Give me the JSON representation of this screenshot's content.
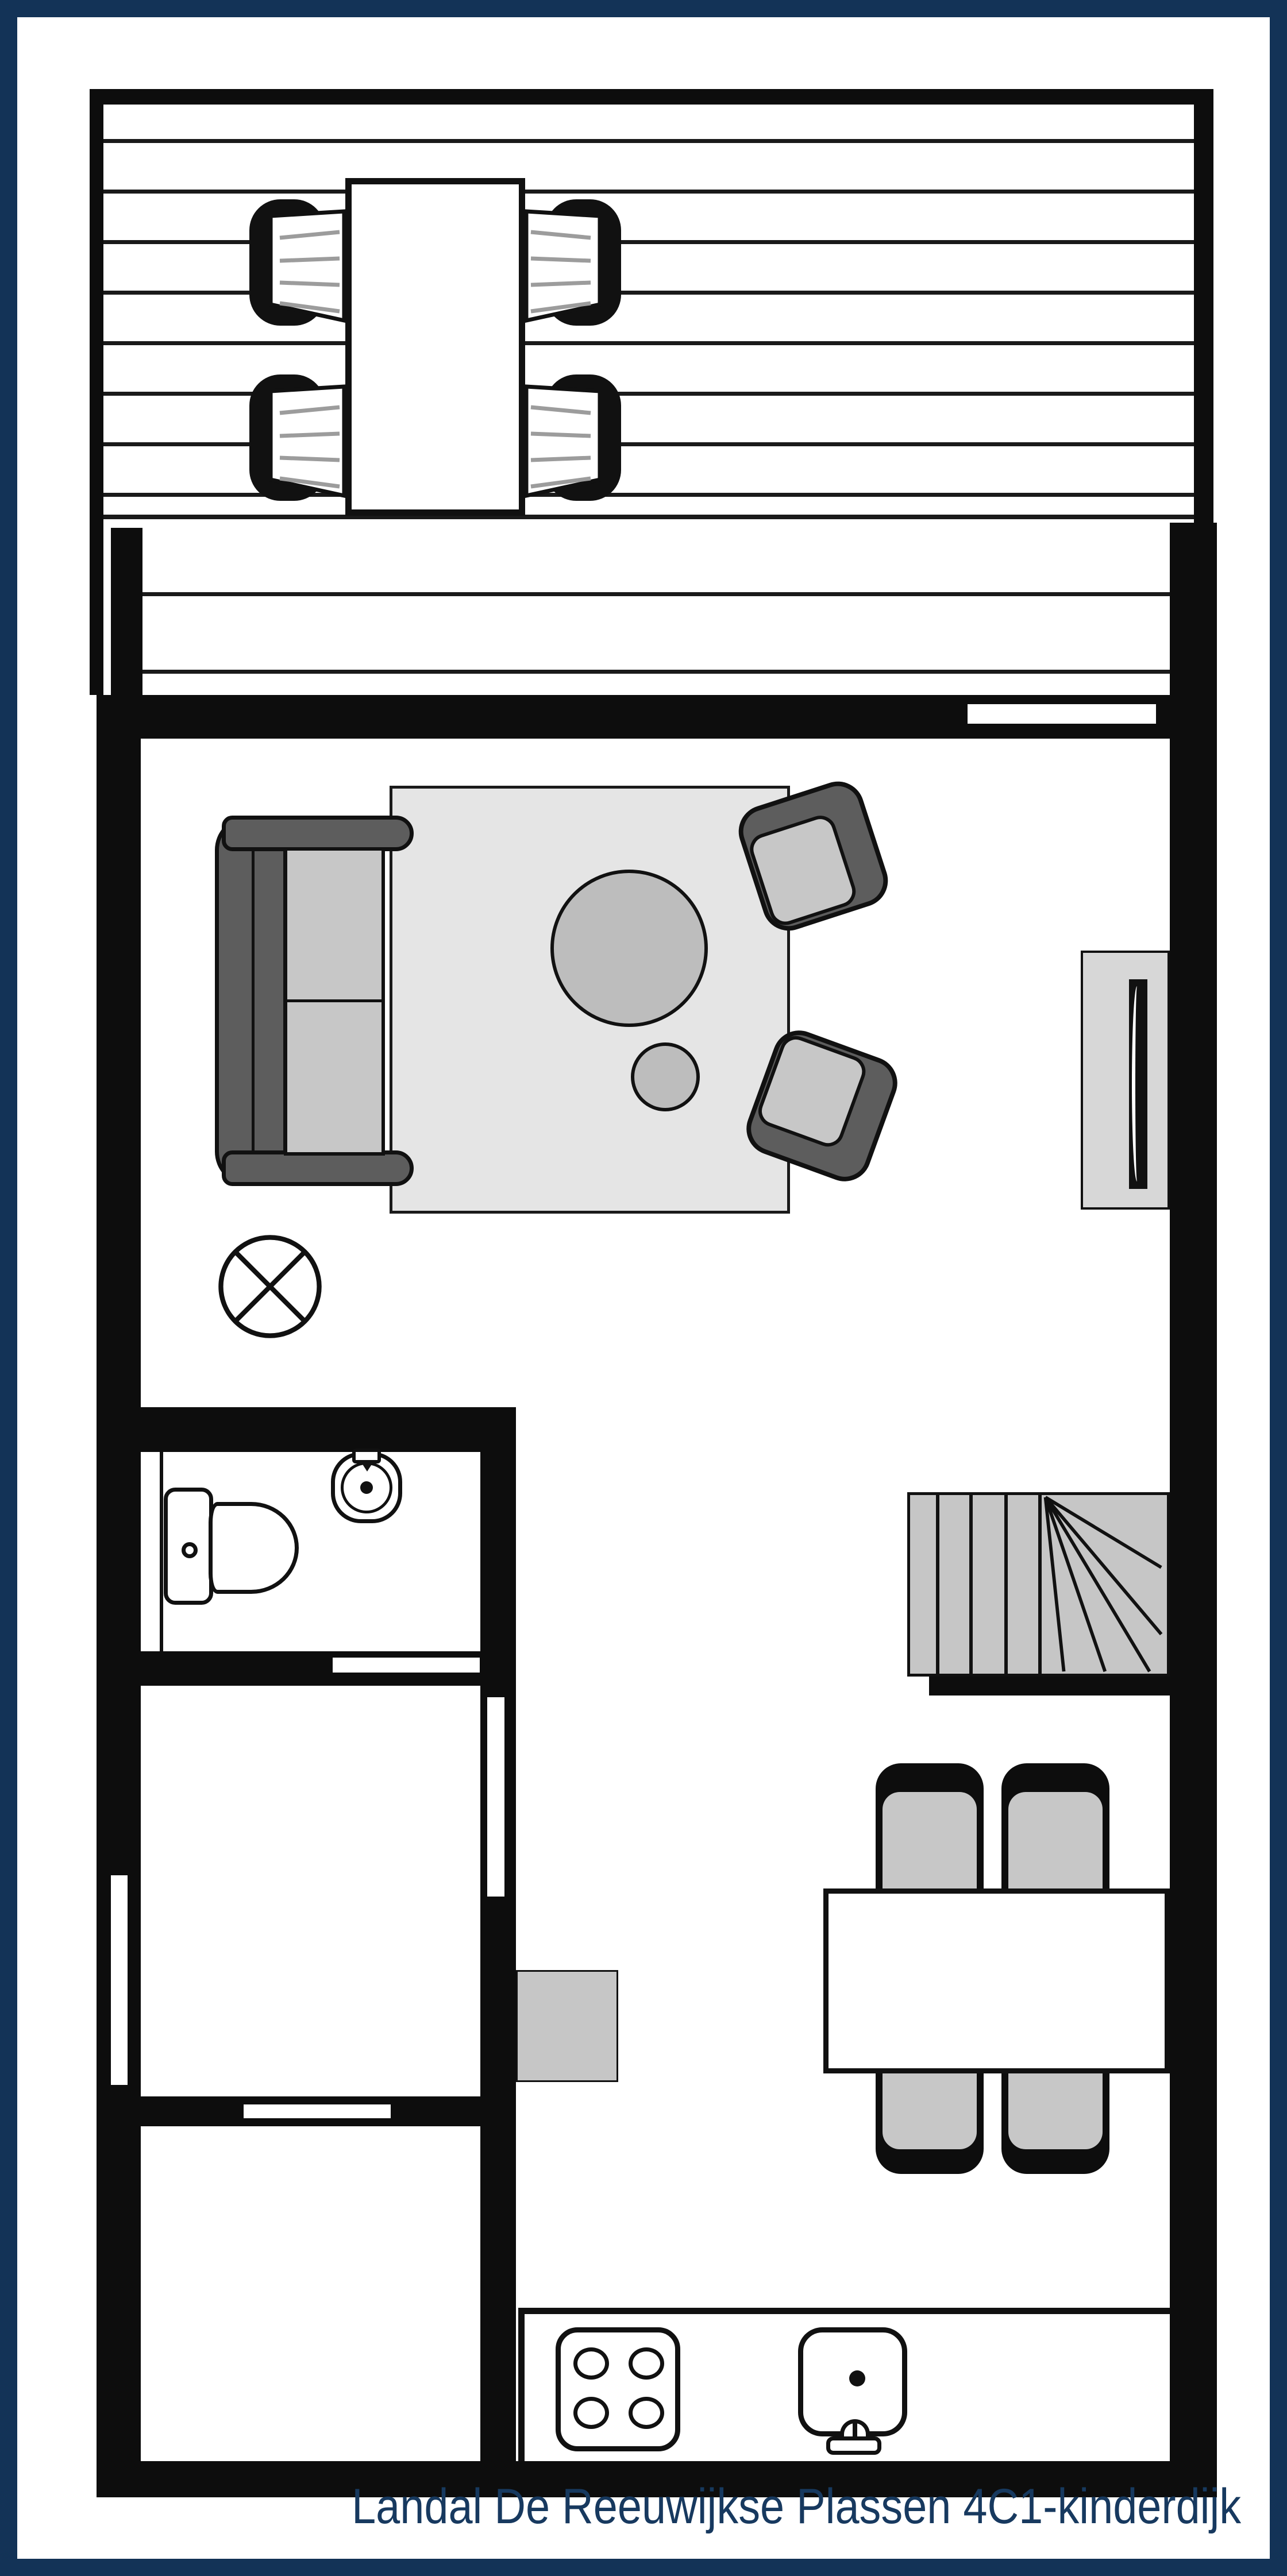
{
  "caption": "Landal De Reeuwijkse Plassen 4C1-kinderdijk",
  "colors": {
    "border_navy": "#133357",
    "caption_navy": "#17395f",
    "wall_black": "#0d0d0d",
    "outline_black": "#111111",
    "furniture_dark_gray": "#5d5d5d",
    "cushion_gray": "#c7c7c7",
    "rug_gray": "#e5e5e5",
    "table_gray": "#bdbdbd",
    "stair_gray": "#c6c6c6",
    "seat_stripe_gray": "#9c9c9c",
    "radiator_gray": "#d7d7d7"
  },
  "plan": {
    "type": "floor-plan",
    "areas": [
      "terrace-deck",
      "living-room",
      "bathroom",
      "storage-room",
      "bedroom",
      "hall",
      "kitchen",
      "dining-area"
    ],
    "fixtures": [
      "outdoor-dining-table",
      "outdoor-chair x4",
      "sofa",
      "rug",
      "coffee-table",
      "side-table",
      "armchair x2",
      "radiator",
      "ceiling-light",
      "toilet",
      "wash-basin",
      "winder-staircase",
      "dining-table",
      "dining-chair x4",
      "kitchen-cabinet",
      "kitchen-counter",
      "stove-4-burners",
      "kitchen-sink"
    ],
    "openings": [
      "terrace-sliding-door",
      "left-wall-window",
      "bathroom-sliding-door",
      "hall-door",
      "bedroom-sliding-door"
    ]
  }
}
